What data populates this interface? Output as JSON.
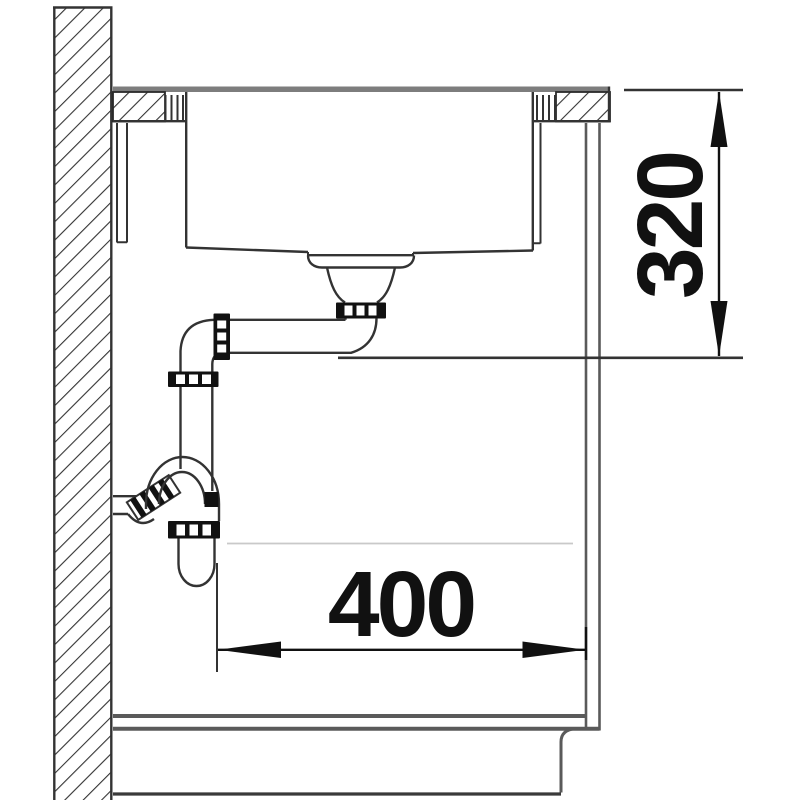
{
  "diagram": {
    "type": "technical-installation-section",
    "subject": "kitchen sink built into worktop with drain piping and base cabinet, side section view",
    "dimensions": {
      "vertical": {
        "label": "320",
        "orientation": "vertical"
      },
      "horizontal": {
        "label": "400",
        "orientation": "horizontal"
      }
    },
    "parts": [
      "wall",
      "worktop",
      "sink-bowl",
      "sink-fastening-clamps",
      "drain-strainer",
      "drain-pipe",
      "pipe-union-nuts",
      "siphon-trap",
      "wall-outlet",
      "base-cabinet",
      "cabinet-plinth"
    ]
  },
  "colors": {
    "line": "#333333",
    "dark": "#111111",
    "gray_surface": "#7d7d7d",
    "cabinet_gray": "#5a5a5a",
    "faint": "#c9c9c9",
    "background": "#ffffff"
  }
}
